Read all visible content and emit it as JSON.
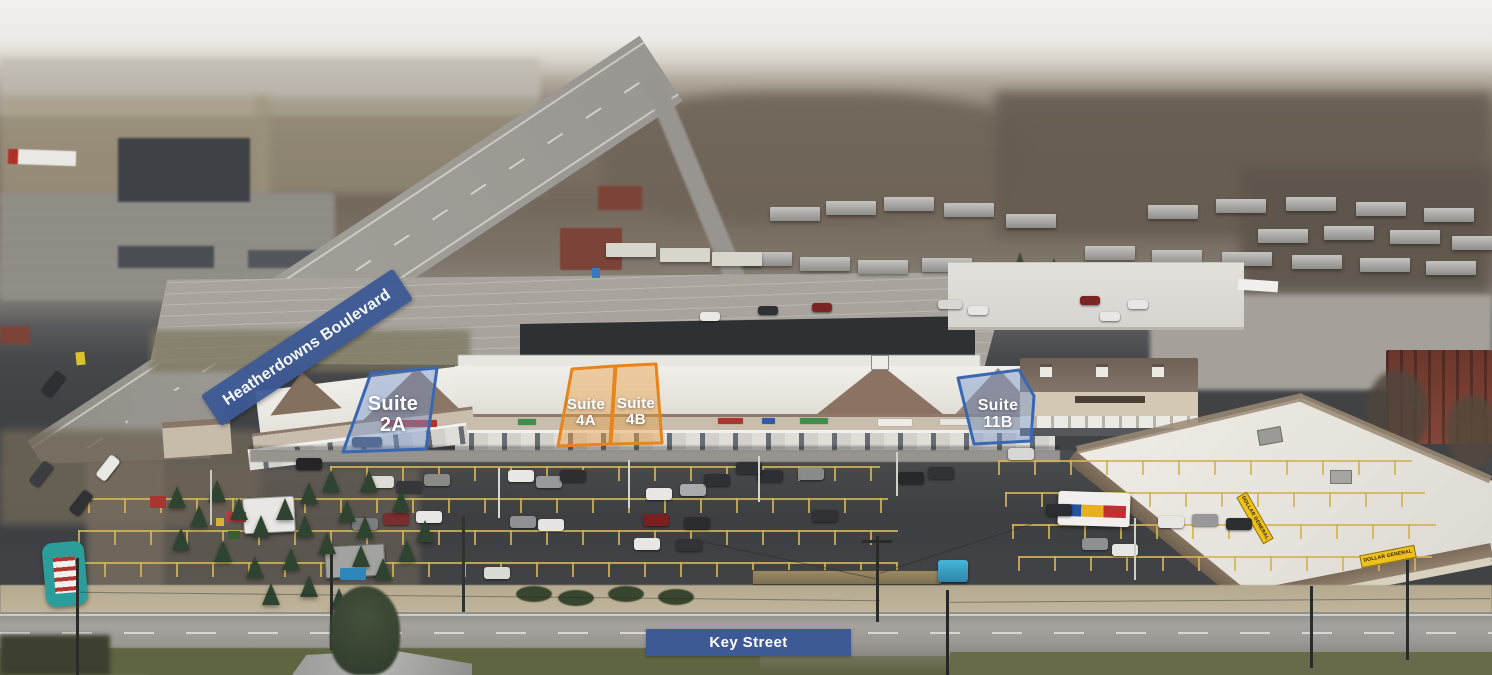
{
  "annotations": {
    "street_banner": {
      "label": "Heatherdowns Boulevard"
    },
    "bottom_street": {
      "label": "Key Street"
    },
    "suites": [
      {
        "name": "Suite",
        "unit": "2A",
        "highlight": "blue"
      },
      {
        "name": "Suite",
        "unit": "4A",
        "highlight": "orange"
      },
      {
        "name": "Suite",
        "unit": "4B",
        "highlight": "orange"
      },
      {
        "name": "Suite",
        "unit": "11B",
        "highlight": "blue"
      }
    ]
  },
  "signage": {
    "dollar_general_front": "DOLLAR GENERAL",
    "dollar_general_side": "DOLLAR GENERAL"
  },
  "colors": {
    "overlay-blue": "#3a67b2",
    "overlay-blue-fill": "rgba(120,150,205,0.45)",
    "overlay-orange": "#e8841c",
    "overlay-orange-fill": "rgba(233,160,70,0.45)",
    "banner-navy": "#3d5a96",
    "label-text": "#ffffff",
    "dg-yellow": "#eec11e"
  }
}
